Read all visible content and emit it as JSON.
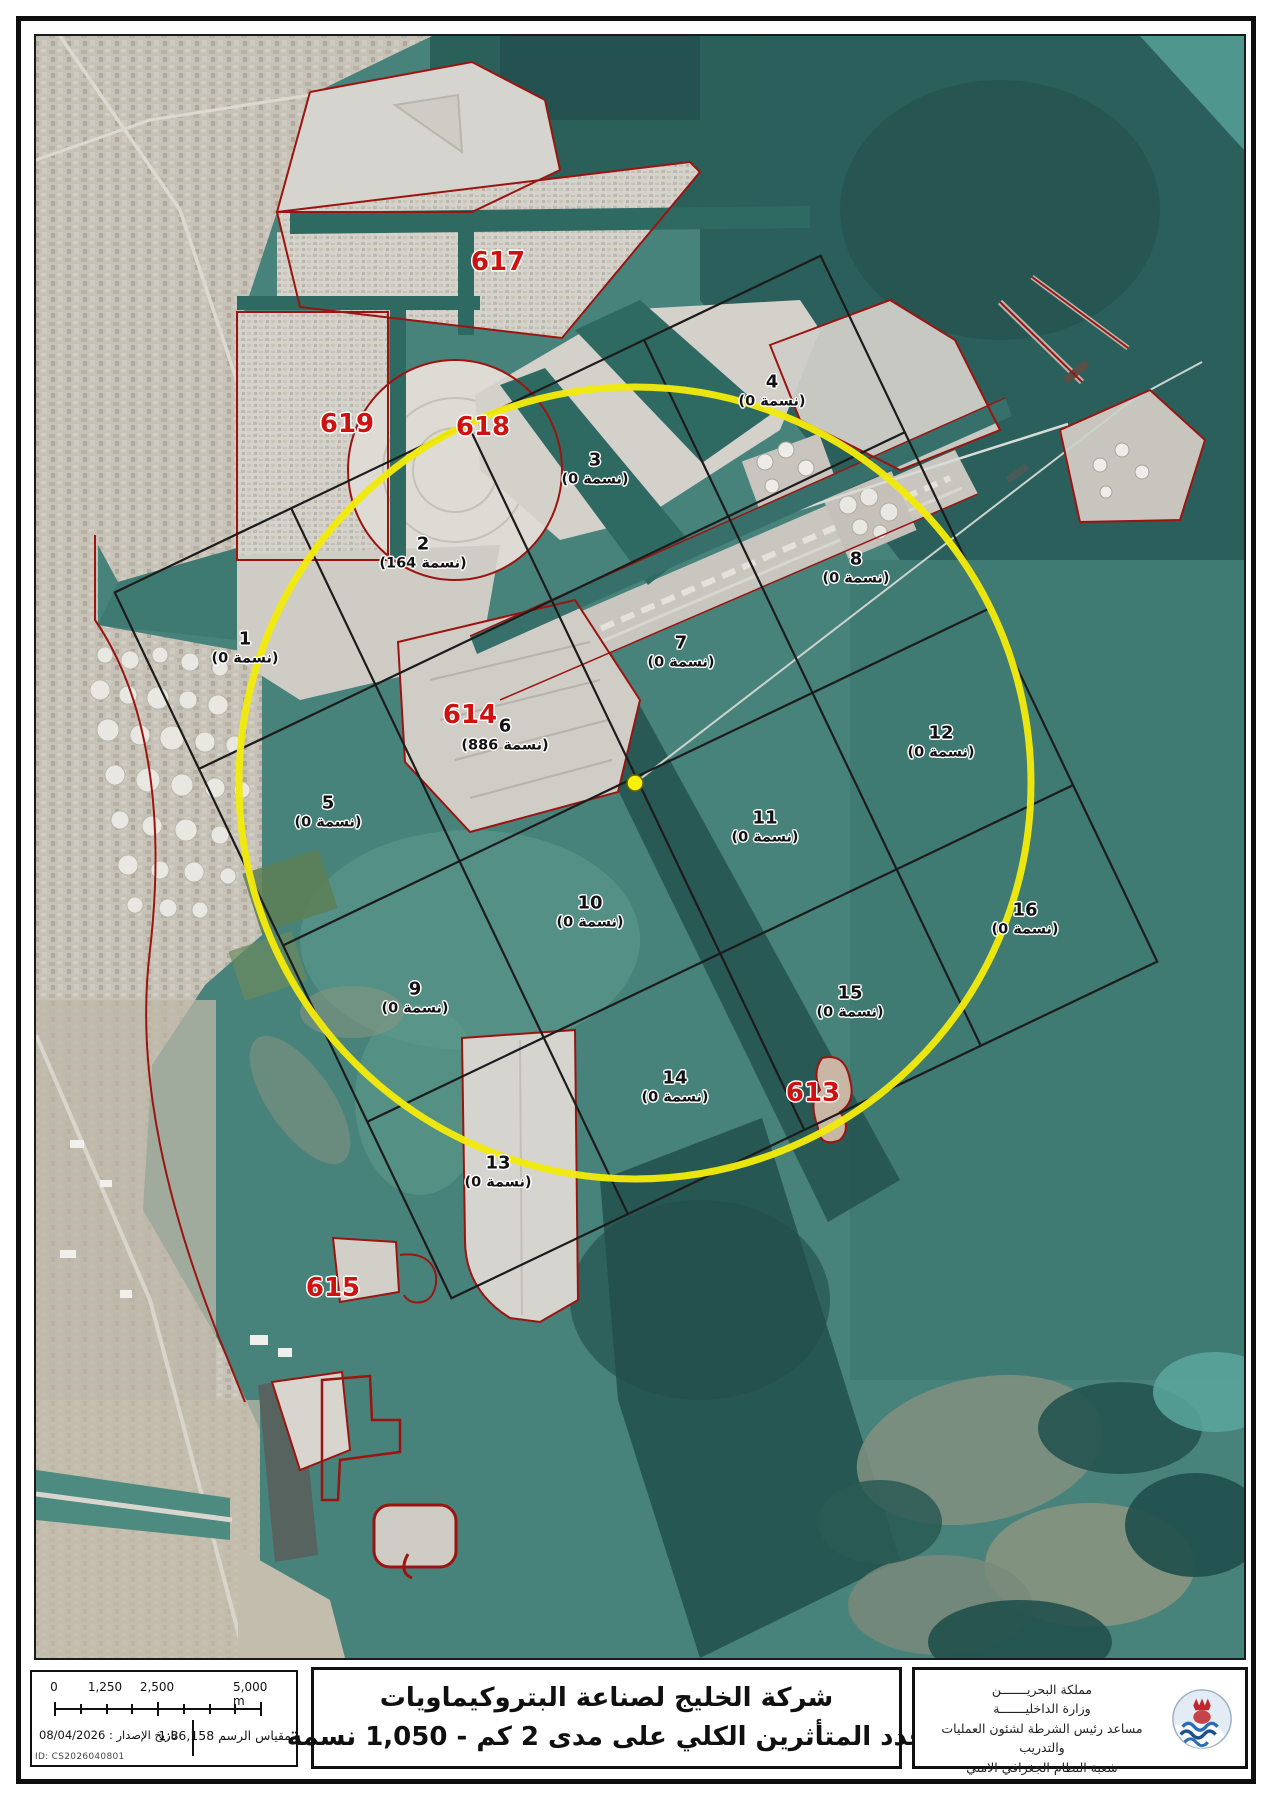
{
  "title_block": {
    "line1": "شركة الخليج لصناعة البتروكيماويات",
    "line2": "عدد المتأثرين الكلي على مدى 2 كم - 1,050 نسمة"
  },
  "ministry_block": {
    "line1": "مملكة البحريـــــــن",
    "line2": "وزارة الداخليـــــــة",
    "line3": "مساعد رئيس الشرطة لشئون العمليات والتدريب",
    "line4": "شعبة النظام الجغرافي الامني"
  },
  "scale_block": {
    "tick_labels": [
      "0",
      "1,250",
      "2,500",
      "5,000 m"
    ],
    "date_label": "تاريخ الإصدار :",
    "date_value": "08/04/2026",
    "scale_label": "مقياس الرسم",
    "scale_value": "1:86,158",
    "doc_id": "ID: CS2026040801"
  },
  "map": {
    "impact_circle": {
      "center_x": 635,
      "center_y": 783,
      "radius": 396
    },
    "grid_cells": [
      {
        "number": "1",
        "count": "(نسمة 0)",
        "x": 245,
        "y": 648
      },
      {
        "number": "2",
        "count": "(نسمة 164)",
        "x": 423,
        "y": 553
      },
      {
        "number": "3",
        "count": "(نسمة 0)",
        "x": 595,
        "y": 469
      },
      {
        "number": "4",
        "count": "(نسمة 0)",
        "x": 772,
        "y": 391
      },
      {
        "number": "5",
        "count": "(نسمة 0)",
        "x": 328,
        "y": 812
      },
      {
        "number": "6",
        "count": "(نسمة 886)",
        "x": 505,
        "y": 735
      },
      {
        "number": "7",
        "count": "(نسمة 0)",
        "x": 681,
        "y": 652
      },
      {
        "number": "8",
        "count": "(نسمة 0)",
        "x": 856,
        "y": 568
      },
      {
        "number": "9",
        "count": "(نسمة 0)",
        "x": 415,
        "y": 998
      },
      {
        "number": "10",
        "count": "(نسمة 0)",
        "x": 590,
        "y": 912
      },
      {
        "number": "11",
        "count": "(نسمة 0)",
        "x": 765,
        "y": 827
      },
      {
        "number": "12",
        "count": "(نسمة 0)",
        "x": 941,
        "y": 742
      },
      {
        "number": "13",
        "count": "(نسمة 0)",
        "x": 498,
        "y": 1172
      },
      {
        "number": "14",
        "count": "(نسمة 0)",
        "x": 675,
        "y": 1087
      },
      {
        "number": "15",
        "count": "(نسمة 0)",
        "x": 850,
        "y": 1002
      },
      {
        "number": "16",
        "count": "(نسمة 0)",
        "x": 1025,
        "y": 919
      }
    ],
    "zone_labels": [
      {
        "text": "617",
        "x": 498,
        "y": 262
      },
      {
        "text": "619",
        "x": 347,
        "y": 424
      },
      {
        "text": "618",
        "x": 483,
        "y": 427
      },
      {
        "text": "614",
        "x": 470,
        "y": 715
      },
      {
        "text": "613",
        "x": 813,
        "y": 1093
      },
      {
        "text": "615",
        "x": 333,
        "y": 1288
      }
    ],
    "colors": {
      "circle_yellow": "#f2e90c",
      "zone_label_red": "#ce1210",
      "boundary_red": "#9b1410",
      "grid_line": "#1c1c1c",
      "water_base": "#47837b",
      "land_base": "#c8c3b8",
      "reclaimed_pad": "#d6d3cd"
    }
  }
}
